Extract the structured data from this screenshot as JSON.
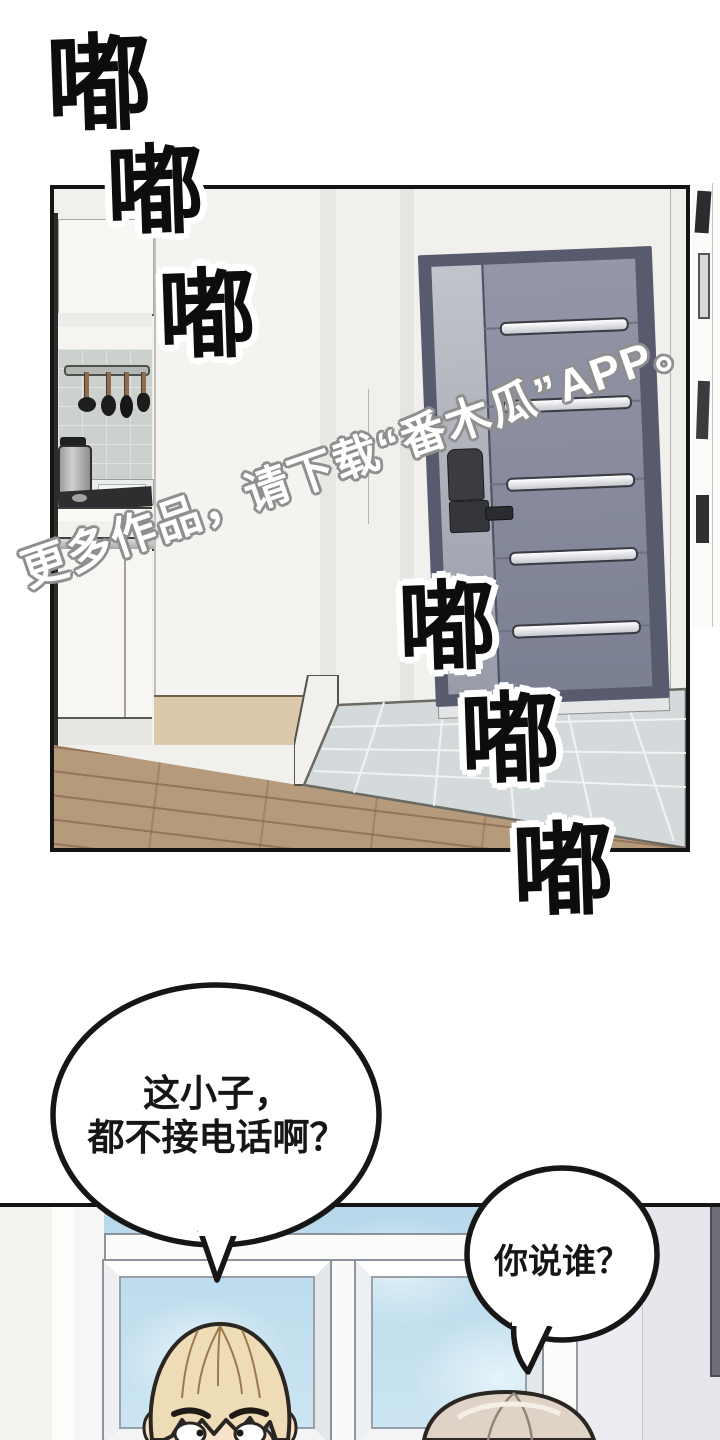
{
  "page": {
    "type": "comic-page",
    "language": "zh-CN"
  },
  "sfx": {
    "meaning": "knocking-sound-effect",
    "chars": [
      "嘟",
      "嘟",
      "嘟",
      "嘟",
      "嘟",
      "嘟"
    ]
  },
  "watermark": {
    "text": "更多作品，请下载“番木瓜”APP。"
  },
  "dialogue": {
    "bubble1": {
      "line1": "这小子，",
      "line2": "都不接电话啊？"
    },
    "bubble2": {
      "line1": "你说谁？"
    }
  },
  "scene": {
    "panel1": "apartment-entry-with-kitchen-and-front-door",
    "panel2": "blond-man-in-front-of-window"
  },
  "colors": {
    "door": "#8b8fa1",
    "door_frame": "#575b6d",
    "sky": "#b7d8eb",
    "wood_floor": "#b69a7c",
    "entry_tile": "#d4d9db",
    "hair_front": "#eedcb6",
    "hair_back": "#ded3c6",
    "ink_outline": "#141414"
  }
}
